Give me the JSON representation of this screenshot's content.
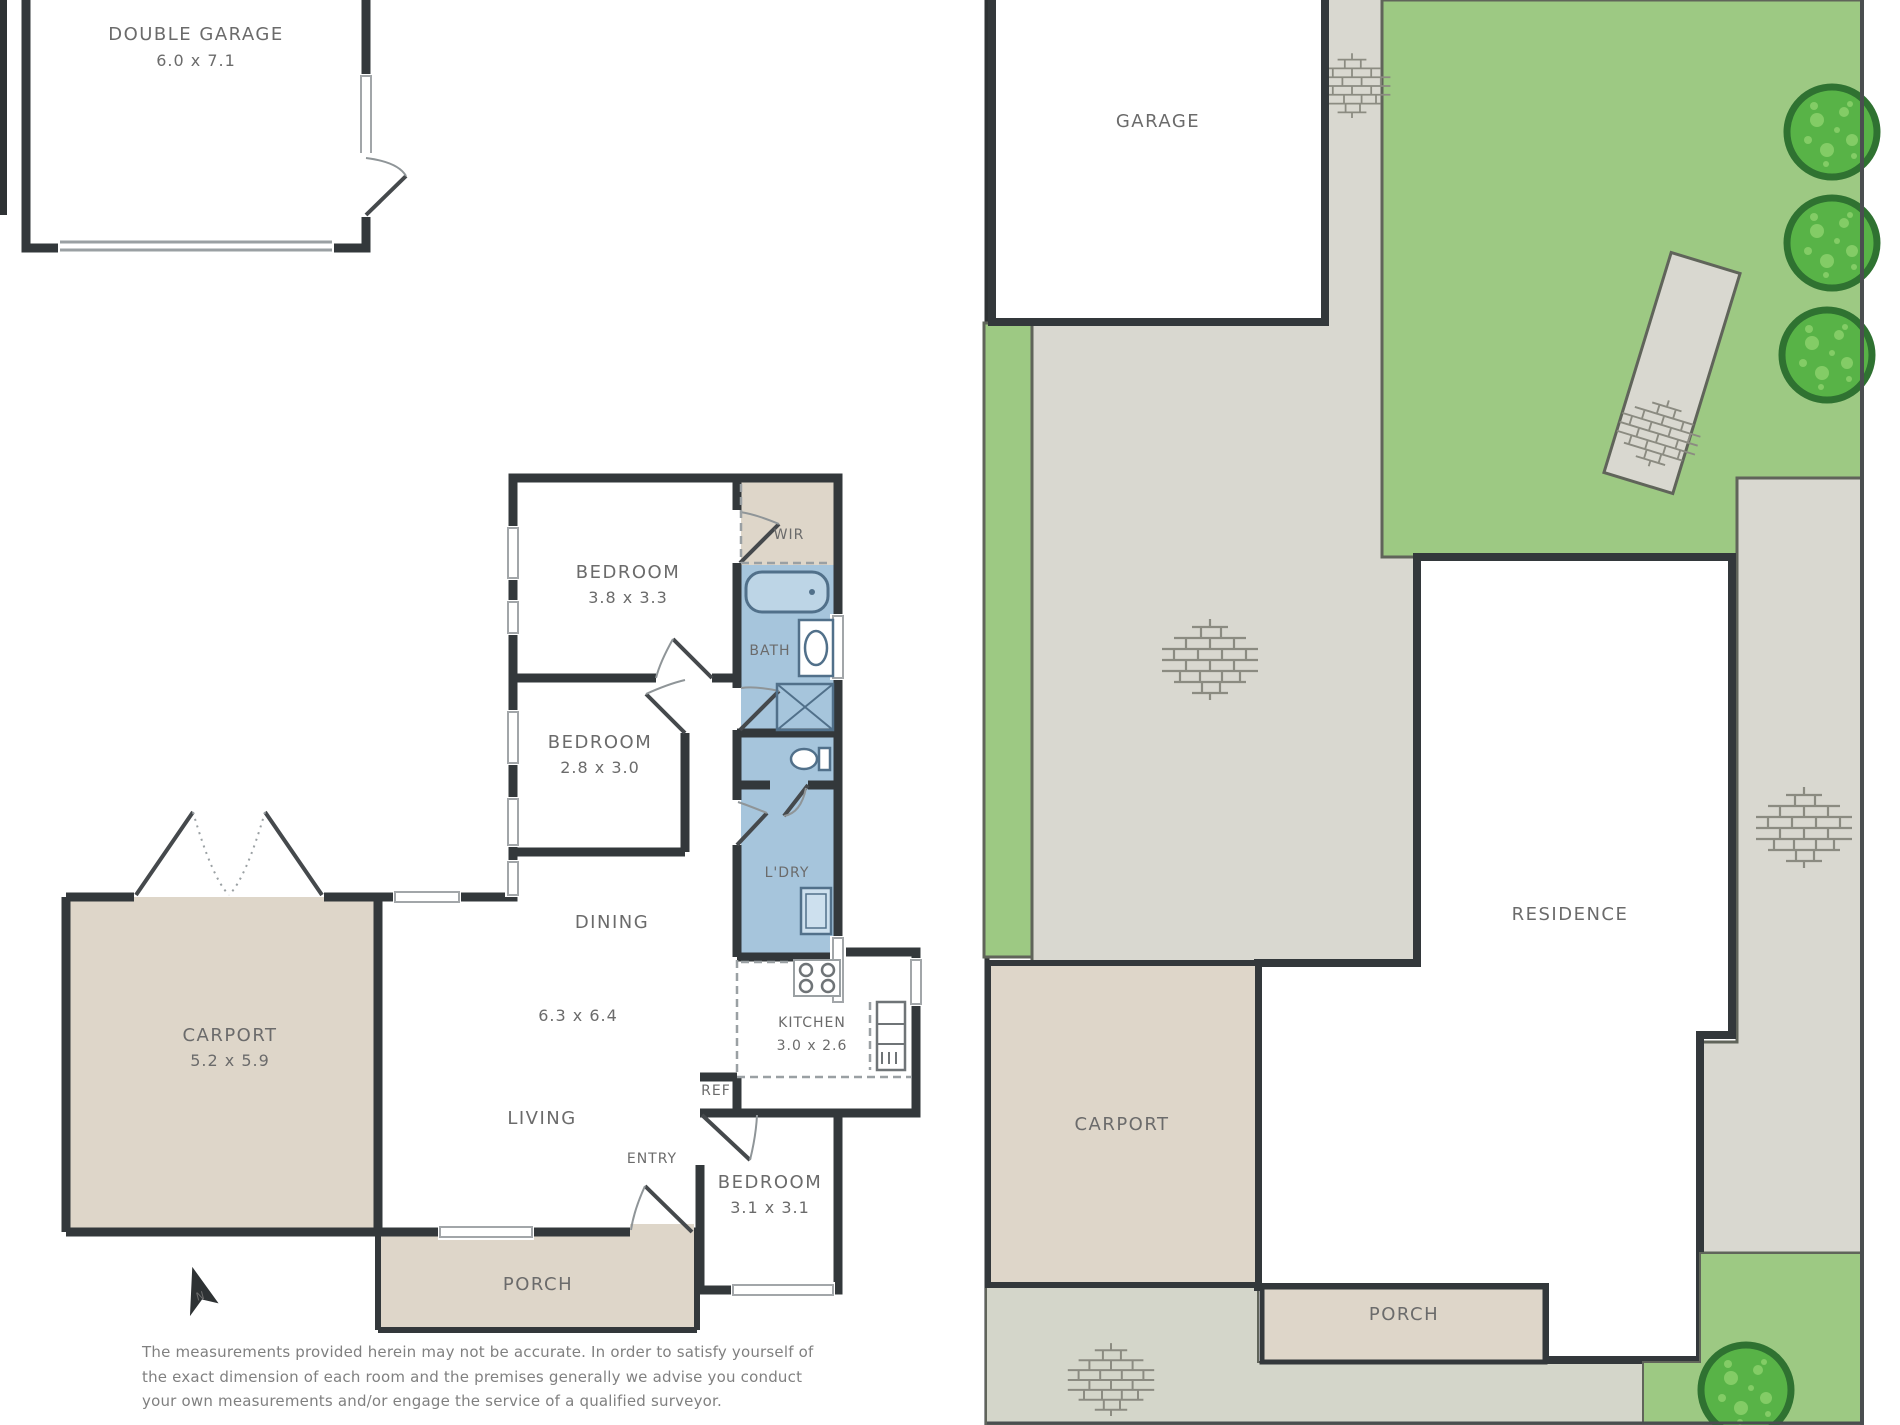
{
  "colors": {
    "wall": "#33383b",
    "tan": "#ded6c9",
    "bath_blue": "#a6c5dc",
    "grass_green": "#9dc983",
    "tree_fill": "#58b347",
    "tree_ring": "#2f7231",
    "paving_gray": "#d9d8d0",
    "label_gray": "#6b6b6b"
  },
  "floor_plan": {
    "rooms": {
      "double_garage": {
        "label": "DOUBLE GARAGE",
        "dims": "6.0 x 7.1"
      },
      "bedroom_1": {
        "label": "BEDROOM",
        "dims": "3.8 x 3.3"
      },
      "bedroom_2": {
        "label": "BEDROOM",
        "dims": "2.8 x 3.0"
      },
      "bedroom_3": {
        "label": "BEDROOM",
        "dims": "3.1 x 3.1"
      },
      "wir": {
        "label": "WIR"
      },
      "bath": {
        "label": "BATH"
      },
      "laundry": {
        "label": "L'DRY"
      },
      "dining": {
        "label": "DINING"
      },
      "living": {
        "label": "LIVING"
      },
      "living_dining_dims": "6.3 x 6.4",
      "entry": {
        "label": "ENTRY"
      },
      "kitchen": {
        "label": "KITCHEN",
        "dims": "3.0 x 2.6"
      },
      "ref": {
        "label": "REF"
      },
      "carport": {
        "label": "CARPORT",
        "dims": "5.2 x 5.9"
      },
      "porch": {
        "label": "PORCH"
      }
    },
    "north_indicator": "N",
    "disclaimer": [
      "The measurements provided herein may not be accurate.  In order to satisfy yourself of",
      "the exact dimension of each room and the premises generally we advise you conduct",
      "your own measurements and/or engage the service of a qualified surveyor."
    ]
  },
  "site_plan": {
    "labels": {
      "garage": "GARAGE",
      "residence": "RESIDENCE",
      "carport": "CARPORT",
      "porch": "PORCH"
    }
  }
}
